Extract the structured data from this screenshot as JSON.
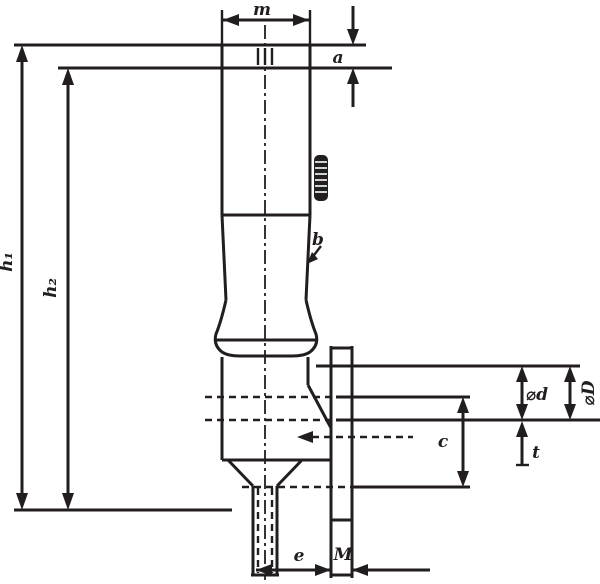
{
  "drawing": {
    "type": "technical-dimension-drawing",
    "subject": "knob-handle-with-threaded-stem",
    "colors": {
      "ink": "#221e1f",
      "background": "#ffffff"
    },
    "labels": {
      "top_width": "m",
      "cap_height": "a",
      "height_outer": "h₁",
      "height_inner": "h₂",
      "knurl": "b",
      "collar_depth": "⌀d",
      "collar_depth_outer": "⌀D",
      "body_depth": "c",
      "step_depth": "t",
      "offset": "e",
      "thread": "M"
    }
  }
}
